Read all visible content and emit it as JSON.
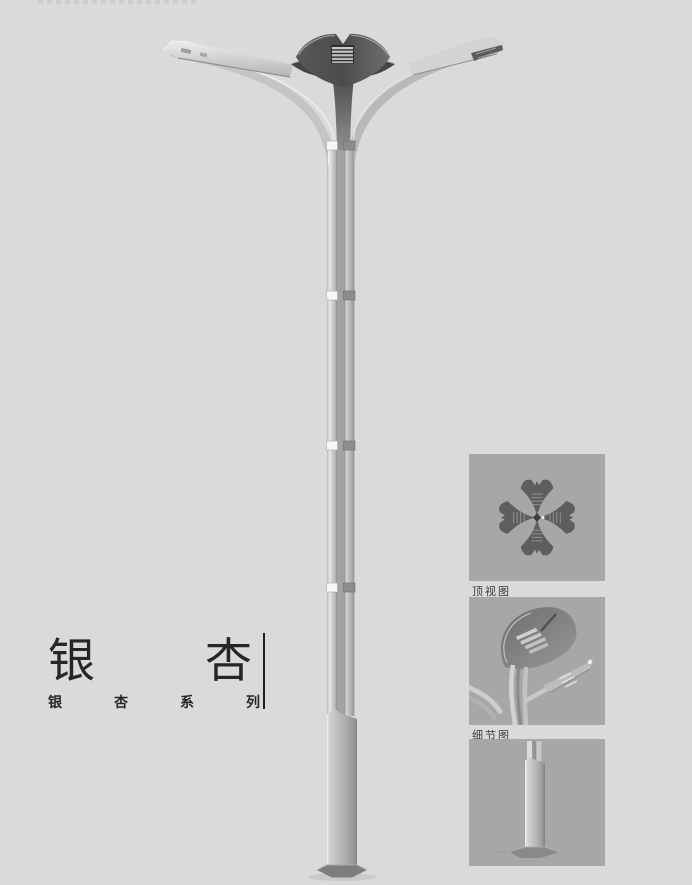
{
  "page": {
    "background_color": "#dadada"
  },
  "product": {
    "title": "银杏",
    "series": "银杏系列",
    "main_image": "ginkgo-double-arm-street-lamp"
  },
  "detail_panels": [
    {
      "label": "顶视图",
      "image": "lamp-top-view"
    },
    {
      "label": "细节图",
      "image": "lamp-head-detail"
    },
    {
      "label": "",
      "image": "pole-base-view"
    }
  ],
  "colors": {
    "background": "#dadada",
    "panel_background": "#a7a7a7",
    "crown_dark": "#555555",
    "pole_light": "#c9c9c9",
    "text": "#262626"
  }
}
